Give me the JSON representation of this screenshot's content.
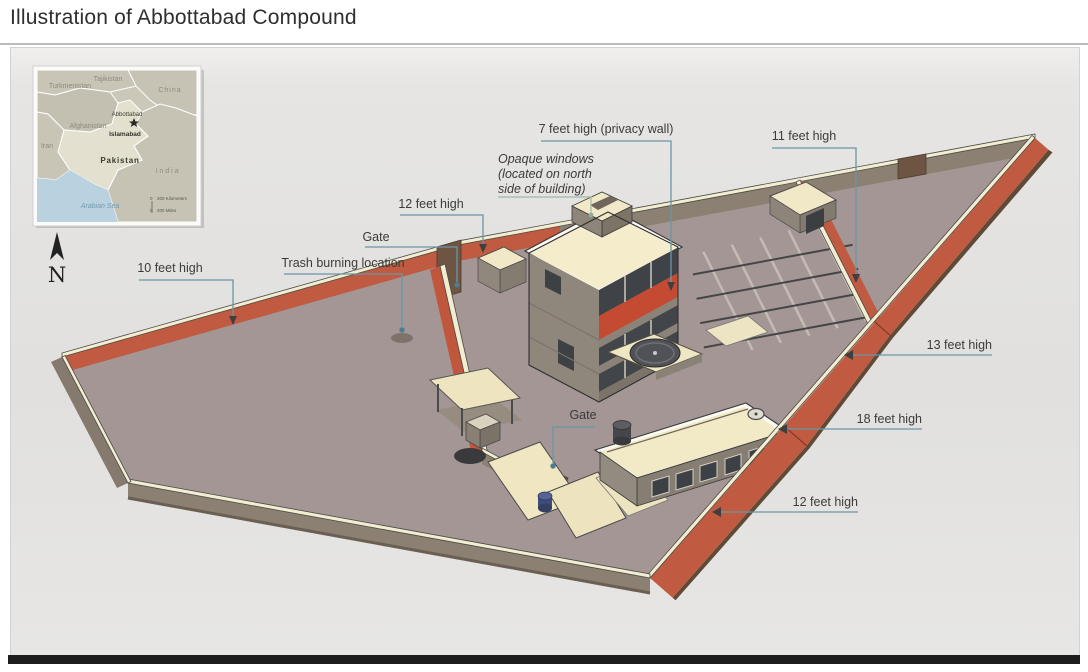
{
  "title": "Illustration of Abbottabad Compound",
  "compass": {
    "label": "N"
  },
  "inset_map": {
    "countries": {
      "turkmenistan": "Turkmenistan",
      "tajikistan": "Tajikistan",
      "china": "China",
      "afghanistan": "Afghanistan",
      "iran": "Iran",
      "pakistan": "Pakistan",
      "india": "India"
    },
    "cities": {
      "abbottabad": "Abbottabad",
      "islamabad": "Islamabad"
    },
    "water": {
      "arabian_sea": "Arabian Sea"
    },
    "scale": {
      "zero_km": "0",
      "kilometers": "200 Kilometers",
      "zero_mi": "0",
      "miles": "200 Miles"
    }
  },
  "annotations": {
    "privacy_wall": "7 feet high (privacy wall)",
    "opaque_windows_line1": "Opaque windows",
    "opaque_windows_line2": "(located on north",
    "opaque_windows_line3": "side of building)",
    "wall_11ft": "11 feet high",
    "wall_12ft_top": "12 feet high",
    "gate_top": "Gate",
    "trash_burning": "Trash burning location",
    "wall_10ft": "10 feet high",
    "wall_13ft": "13 feet high",
    "wall_18ft": "18 feet high",
    "wall_12ft_bottom": "12 feet high",
    "gate_middle": "Gate"
  },
  "colors": {
    "wall_red": "#c05a40",
    "wall_top_cream": "#f2edd0",
    "wall_gray": "#8b8072",
    "ground": "#a39695",
    "roof_cream": "#f4eccb",
    "leader_teal": "#6a96a6",
    "panel_bg": "#e4e3e1"
  }
}
